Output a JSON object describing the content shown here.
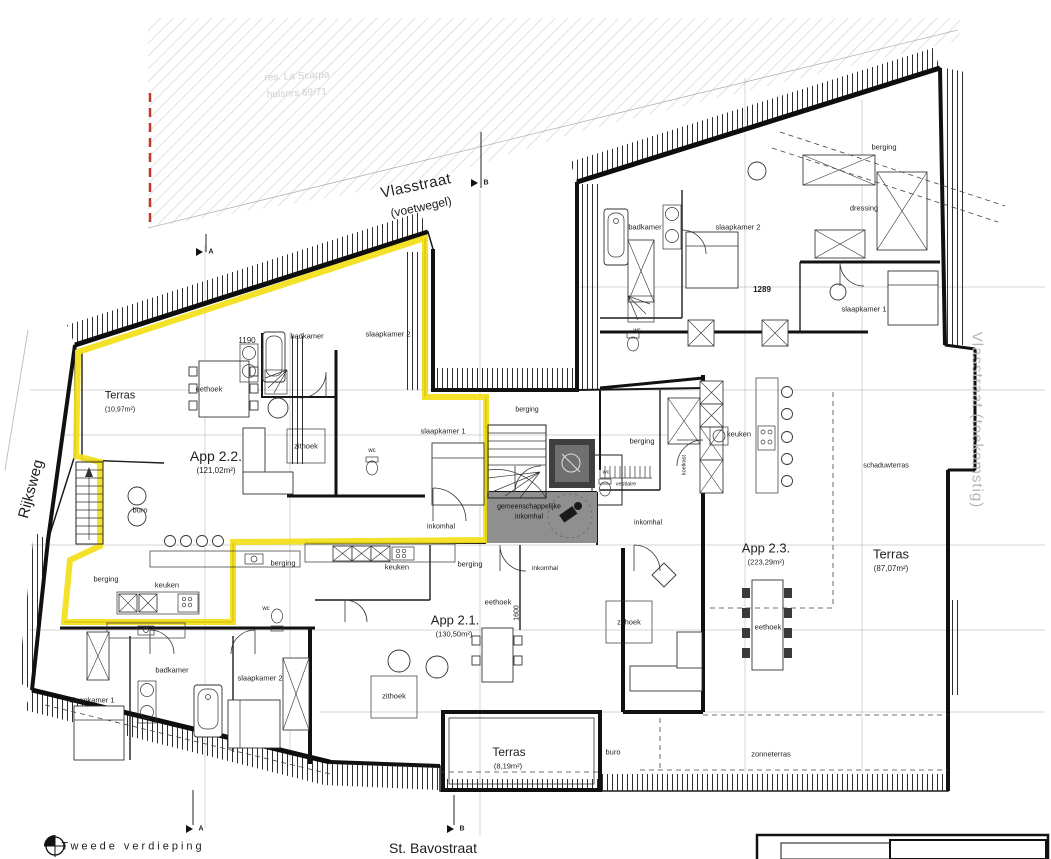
{
  "streets": {
    "top": "Vlasstraat",
    "top_sub": "(voetwegel)",
    "left": "Rijksweg",
    "bottom": "St. Bavostraat",
    "right": "Vlasstraat (toekomstig)"
  },
  "titleblock": {
    "floor": "Tweede verdieping"
  },
  "site_note": {
    "line1": "res. La Scarpa",
    "line2": "huisnrs 69/71"
  },
  "section_markers": {
    "a": "A",
    "b": "B"
  },
  "dimensions": {
    "top_left": "1190",
    "top_right": "1289",
    "middle": "1600"
  },
  "apartments": {
    "app22": {
      "name": "App 2.2.",
      "area": "(121,02m²)"
    },
    "app21": {
      "name": "App 2.1.",
      "area": "(130,50m²)"
    },
    "app23": {
      "name": "App 2.3.",
      "area": "(223,29m²)"
    }
  },
  "terraces": {
    "app22": {
      "name": "Terras",
      "area": "(10,97m²)"
    },
    "app21": {
      "name": "Terras",
      "area": "(8,19m²)"
    },
    "app23": {
      "name": "Terras",
      "area": "(87,07m²)"
    },
    "zonneterras": "zonneterras",
    "schaduwterras": "schaduwterras"
  },
  "rooms": {
    "eethoek": "eethoek",
    "zithoek": "zithoek",
    "badkamer": "badkamer",
    "slaapkamer1": "slaapkamer 1",
    "slaapkamer2": "slaapkamer 2",
    "berging": "berging",
    "keuken": "keuken",
    "wc": "wc",
    "buro": "buro",
    "inkomhal": "inkomhal",
    "vestiaire": "vestiaire",
    "koelkast": "koelkast",
    "dressing": "dressing",
    "hall_line1": "gemeenschappelijke",
    "hall_line2": "inkomhal"
  },
  "colors": {
    "highlight": "#f2df17",
    "hall_fill": "#8f8f8f",
    "boundary_red": "#c0392b"
  }
}
